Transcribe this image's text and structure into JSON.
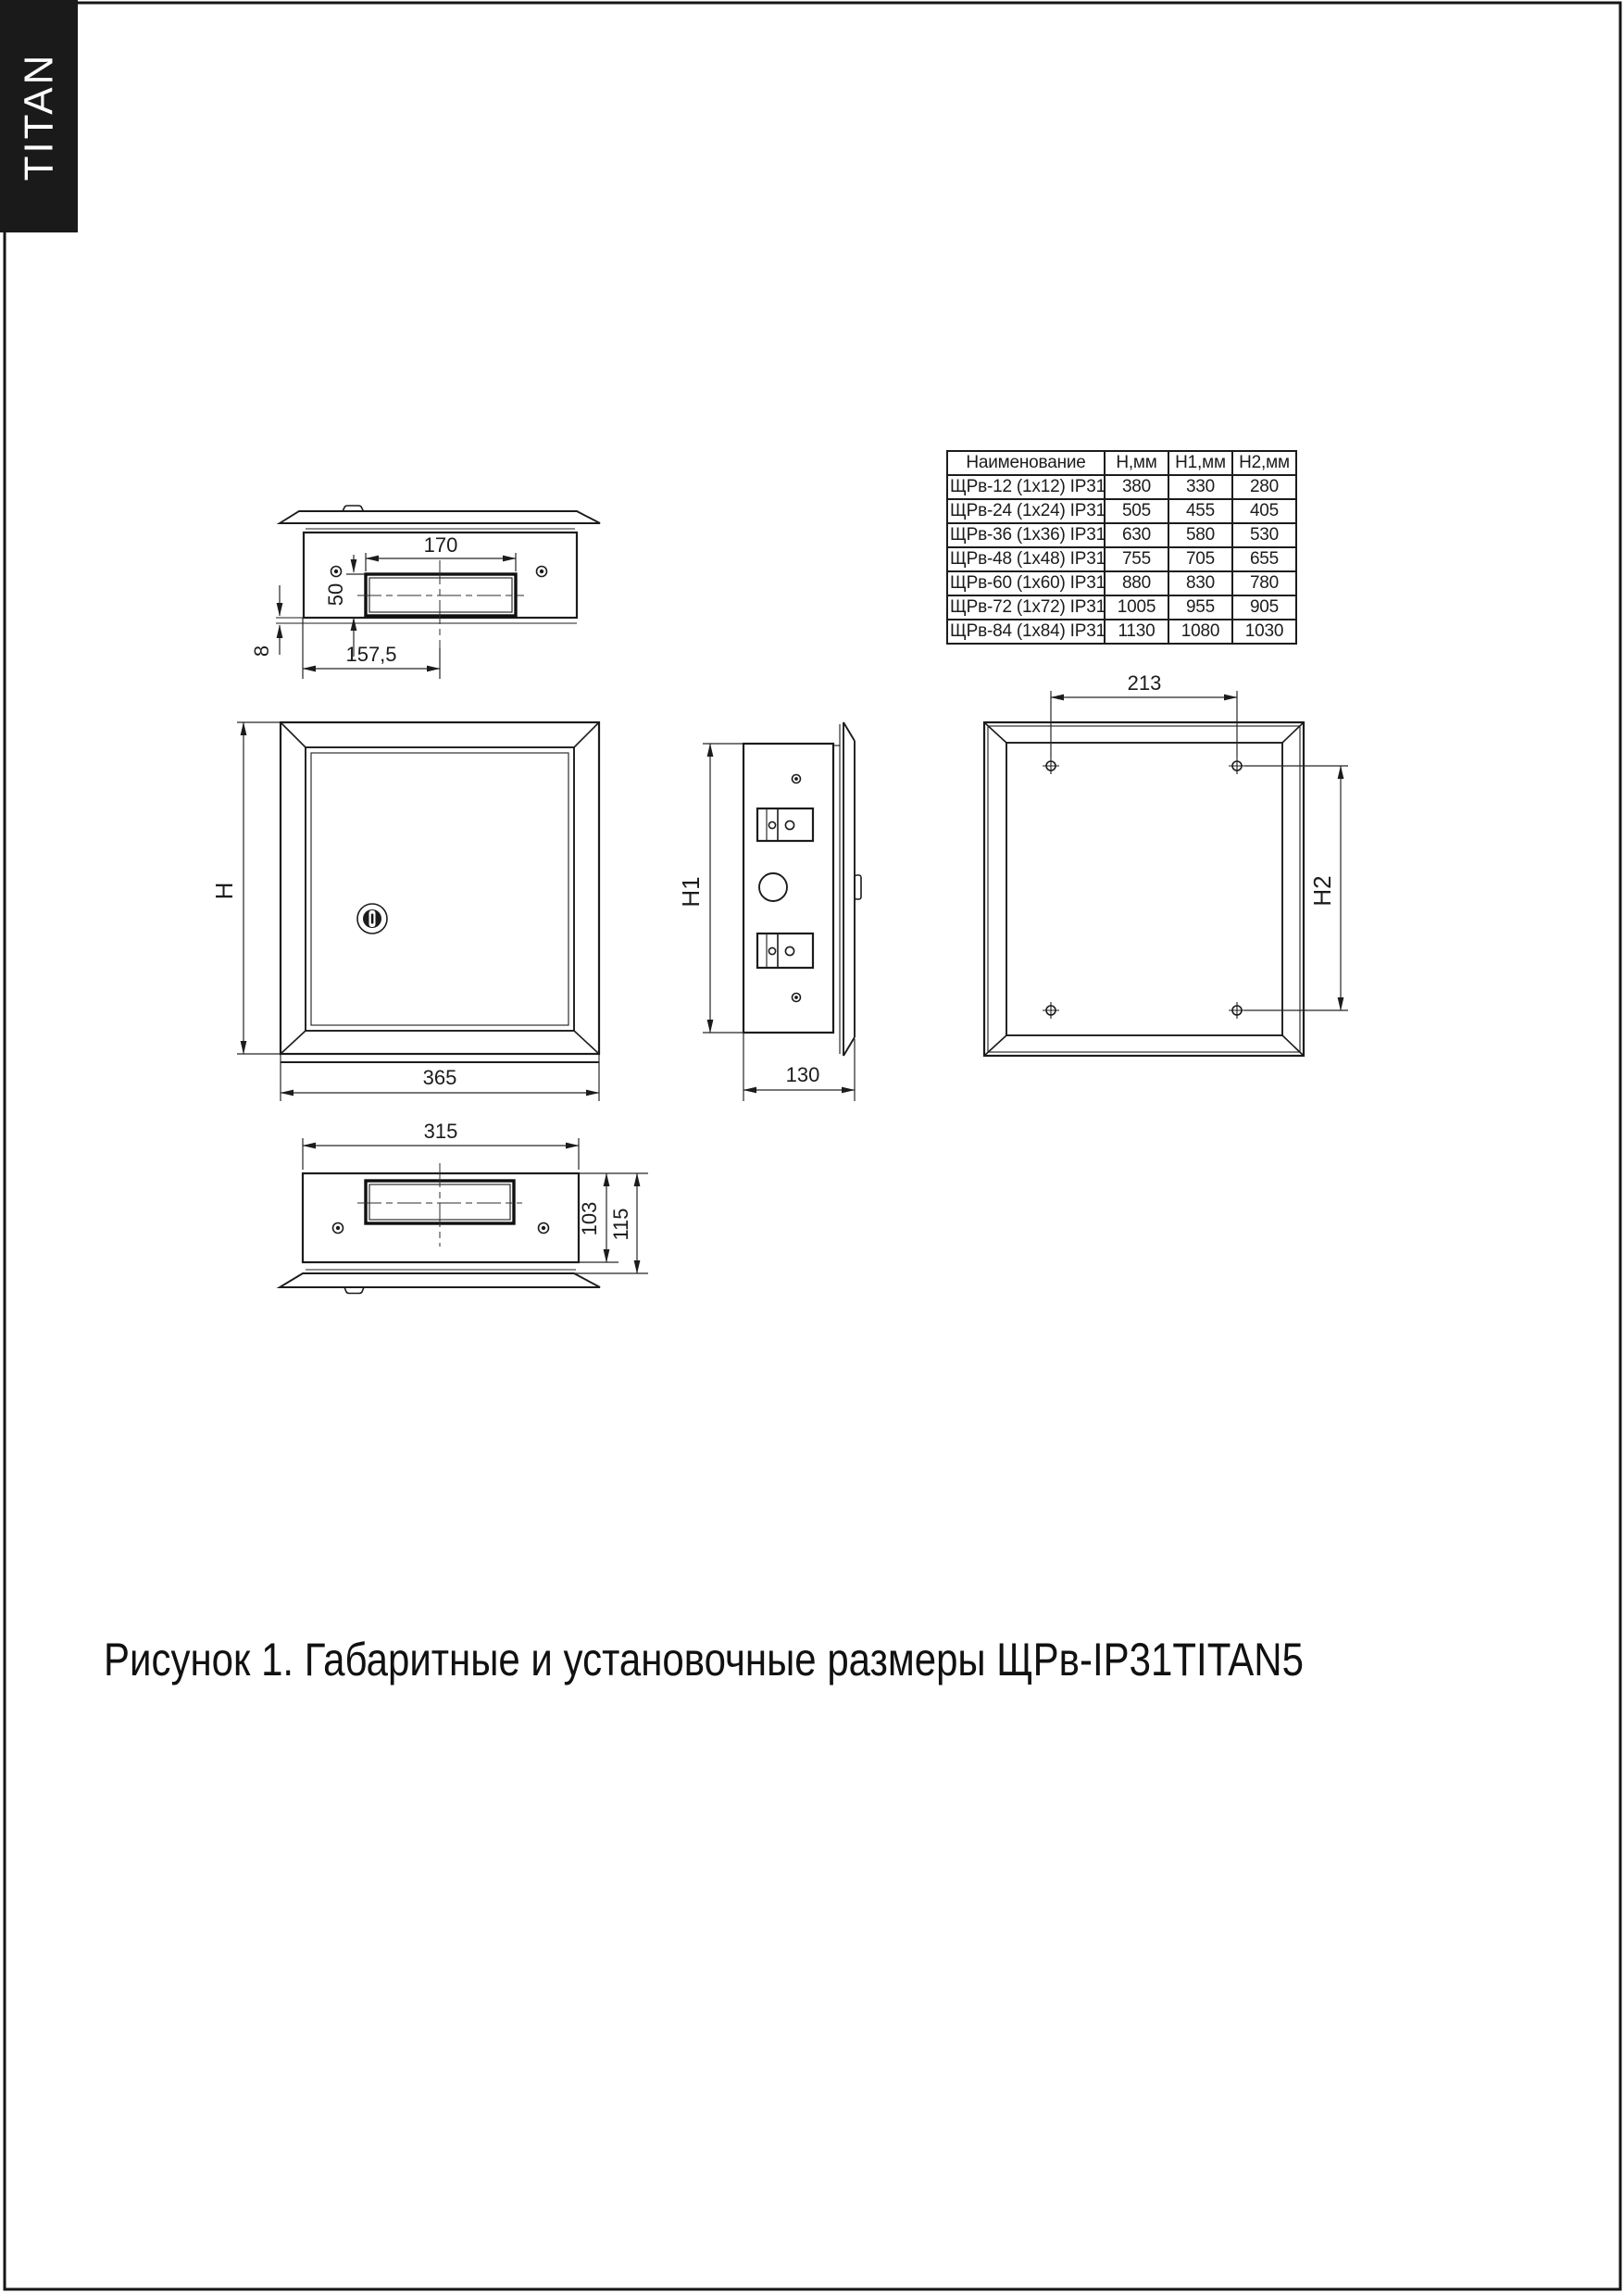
{
  "page": {
    "brand": "TITAN",
    "caption": "Рисунок 1. Габаритные и установочные размеры ЩРв-IP31TITAN5"
  },
  "table": {
    "headers": [
      "Наименование",
      "Н,мм",
      "Н1,мм",
      "Н2,мм"
    ],
    "rows": [
      {
        "name": "ЩРв-12 (1х12) IP31",
        "h": "380",
        "h1": "330",
        "h2": "280"
      },
      {
        "name": "ЩРв-24 (1х24) IP31",
        "h": "505",
        "h1": "455",
        "h2": "405"
      },
      {
        "name": "ЩРв-36 (1х36) IP31",
        "h": "630",
        "h1": "580",
        "h2": "530"
      },
      {
        "name": "ЩРв-48 (1х48) IP31",
        "h": "755",
        "h1": "705",
        "h2": "655"
      },
      {
        "name": "ЩРв-60 (1х60) IP31",
        "h": "880",
        "h1": "830",
        "h2": "780"
      },
      {
        "name": "ЩРв-72 (1х72) IP31",
        "h": "1005",
        "h1": "955",
        "h2": "905"
      },
      {
        "name": "ЩРв-84 (1х84) IP31",
        "h": "1130",
        "h1": "1080",
        "h2": "1030"
      }
    ]
  },
  "dims": {
    "top": {
      "width": "170",
      "height": "50",
      "lip": "8",
      "offset": "157,5"
    },
    "front": {
      "h": "H",
      "width": "365"
    },
    "side": {
      "h": "H1",
      "depth": "130"
    },
    "rear": {
      "holes_x": "213",
      "holes_y": "H2"
    },
    "bottom": {
      "width": "315",
      "body": "103",
      "total": "115"
    }
  }
}
